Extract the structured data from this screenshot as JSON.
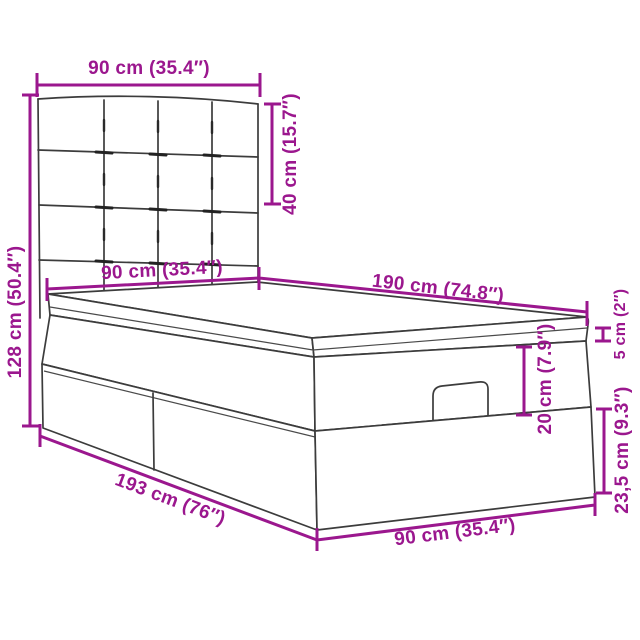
{
  "diagram": {
    "title": "Ottoman storage bed with tufted headboard — dimension diagram",
    "background": "#FFFFFF",
    "accent_color": "#9B178E",
    "line_color": "#3C3C3C",
    "dimensions": [
      {
        "id": "headboard-width",
        "label": "90 cm (35.4″)",
        "cm": 90,
        "inches": 35.4,
        "orientation": "horizontal",
        "measures": "headboard width (top)"
      },
      {
        "id": "headboard-height",
        "label": "40 cm (15.7″)",
        "cm": 40,
        "inches": 15.7,
        "orientation": "vertical",
        "measures": "headboard panel height"
      },
      {
        "id": "overall-height",
        "label": "128 cm (50.4″)",
        "cm": 128,
        "inches": 50.4,
        "orientation": "vertical",
        "measures": "overall bed height"
      },
      {
        "id": "mattress-width",
        "label": "90 cm (35.4″)",
        "cm": 90,
        "inches": 35.4,
        "orientation": "horizontal",
        "measures": "mattress width at head end"
      },
      {
        "id": "mattress-length",
        "label": "190 cm (74.8″)",
        "cm": 190,
        "inches": 74.8,
        "orientation": "diagonal",
        "measures": "mattress length"
      },
      {
        "id": "topper-thickness",
        "label": "5 cm (2″)",
        "cm": 5,
        "inches": 2,
        "orientation": "vertical",
        "measures": "mattress top layer thickness"
      },
      {
        "id": "mattress-depth",
        "label": "20 cm (7.9″)",
        "cm": 20,
        "inches": 7.9,
        "orientation": "vertical",
        "measures": "upper frame / mattress body depth"
      },
      {
        "id": "base-height",
        "label": "23,5 cm (9.3″)",
        "cm": 23.5,
        "inches": 9.3,
        "orientation": "vertical",
        "measures": "storage base height"
      },
      {
        "id": "overall-length",
        "label": "193 cm (76″)",
        "cm": 193,
        "inches": 76,
        "orientation": "diagonal",
        "measures": "overall bed length"
      },
      {
        "id": "overall-width",
        "label": "90 cm (35.4″)",
        "cm": 90,
        "inches": 35.4,
        "orientation": "diagonal",
        "measures": "overall bed width at foot end"
      }
    ]
  }
}
